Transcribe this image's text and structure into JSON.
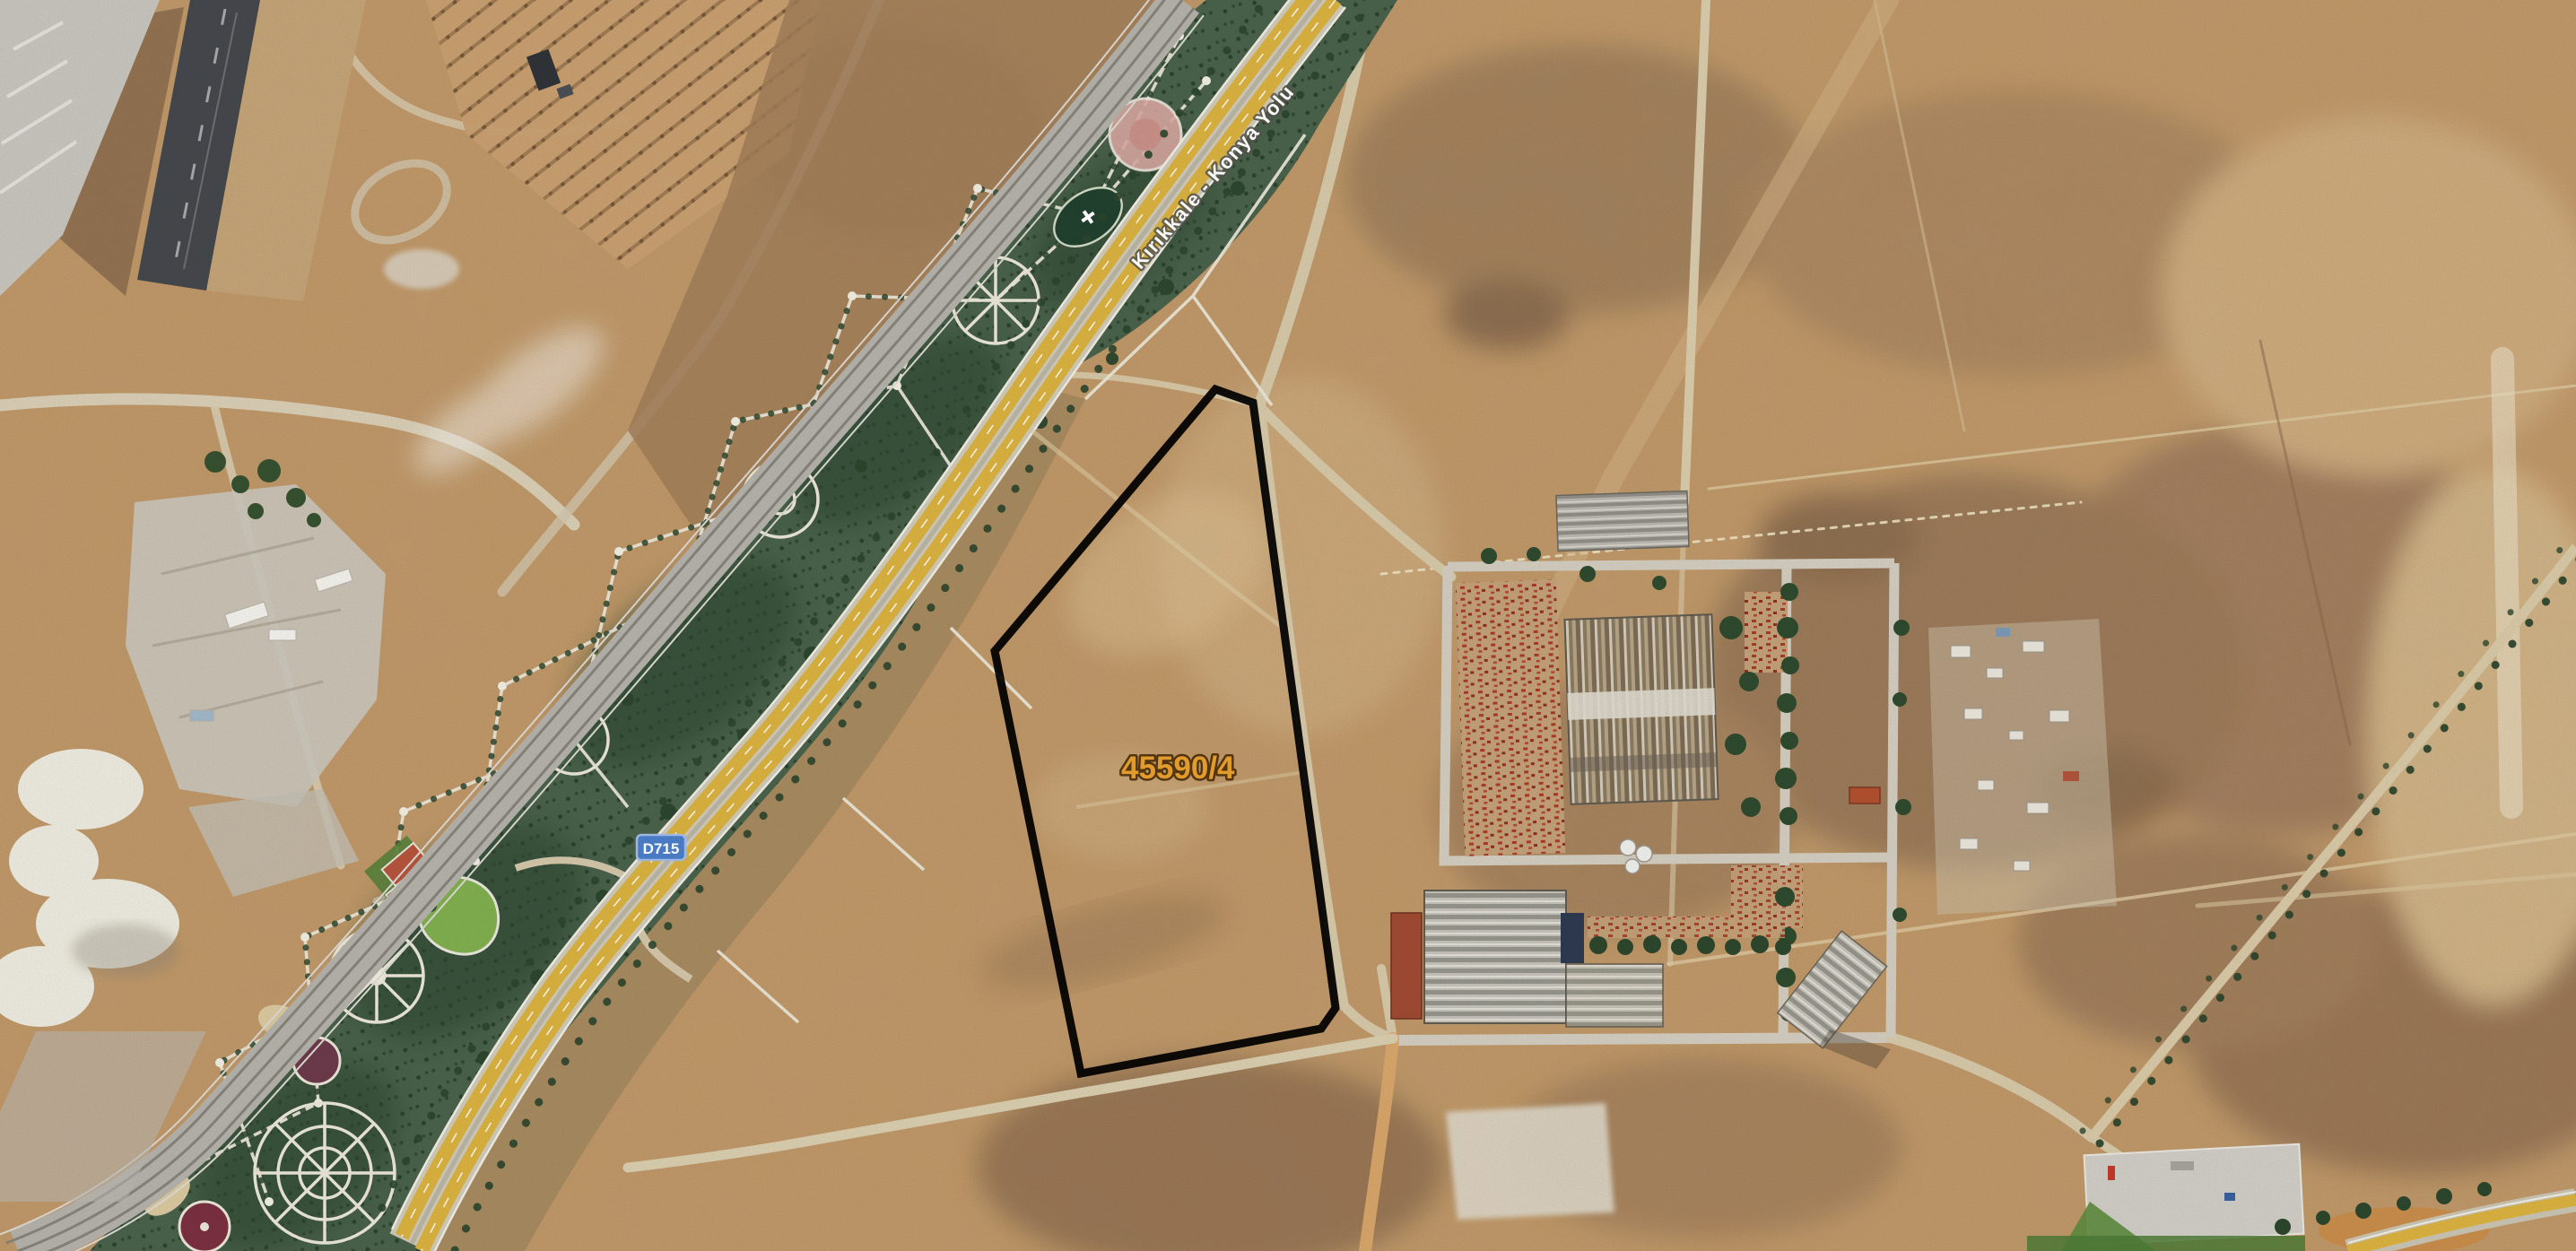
{
  "title": "Satellite parcel map",
  "map": {
    "parcel": {
      "label": "45590/4",
      "outline_color": "#000000",
      "label_color": "#E8A02E"
    },
    "road": {
      "name": "Kırıkkale - Konya Yolu",
      "label_color": "#FFFFFF",
      "surface_color": "#D9B13F"
    },
    "highway_shield": {
      "text": "D715",
      "background": "#4B7EC9",
      "border": "#A3BCE8",
      "text_color": "#FFFFFF"
    },
    "terrain_colors": {
      "field_tan": "#C09868",
      "park_green": "#49614A",
      "railway_grey": "#B4B1AA",
      "runway_dark": "#44474B",
      "quarry_white": "#ECEADE"
    }
  }
}
